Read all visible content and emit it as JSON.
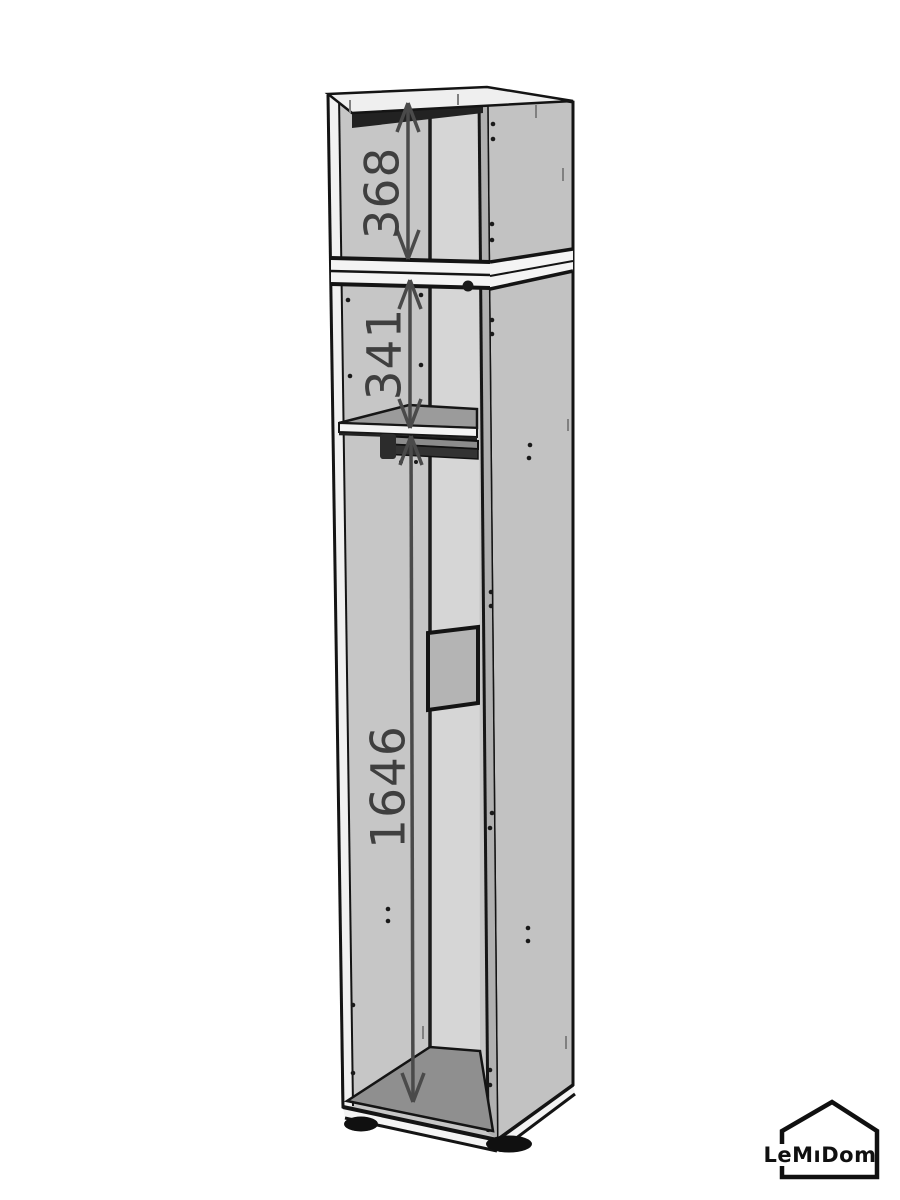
{
  "dimensions": {
    "top": {
      "value": "368"
    },
    "middle": {
      "value": "341"
    },
    "bottom": {
      "value": "1646"
    }
  },
  "logo": {
    "text": "LeMıDom"
  },
  "colors": {
    "background": "#ffffff",
    "outline": "#141414",
    "front_interior_gray": "#c6c6c6",
    "side_panel_gray": "#c2c2c2",
    "back_panel_gray": "#d6d6d6",
    "shelf_gray": "#9b9b9b",
    "floor_gray": "#8f8f8f",
    "dimension_gray": "#4a4a4a"
  }
}
